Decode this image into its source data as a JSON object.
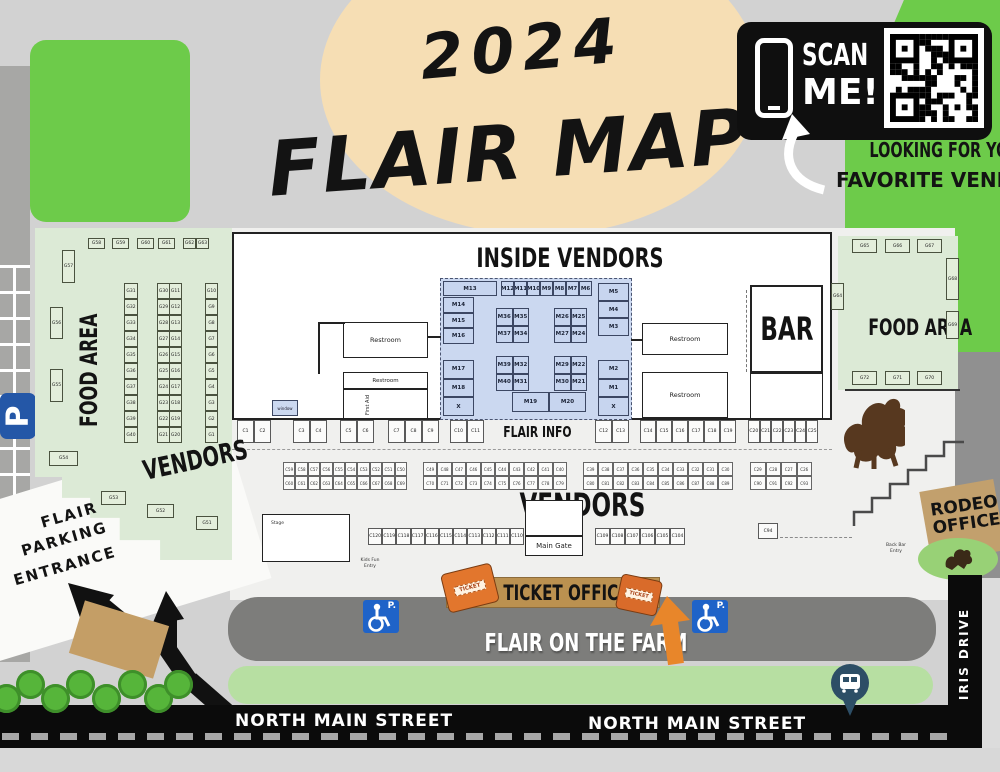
{
  "title": {
    "year": "2024",
    "name": "FLAIR MAP"
  },
  "scan": {
    "line1": "SCAN",
    "line2": "ME!",
    "caption1": "LOOKING FOR YOUR",
    "caption2": "FAVORITE VENDOR?"
  },
  "headings": {
    "inside": "INSIDE VENDORS",
    "vendors_big": "VENDORS",
    "vendors_left": "VENDORS",
    "food_left": "FOOD AREA",
    "food_right": "FOOD AREA",
    "flair_info": "FLAIR INFO",
    "bar": "BAR"
  },
  "roads": {
    "north_main_left": "NORTH MAIN STREET",
    "north_main_right": "NORTH MAIN STREET",
    "iris": "IRIS DRIVE",
    "farm": "FLAIR ON THE FARM"
  },
  "parking": {
    "p": "P",
    "p_dot": "P.",
    "l1": "FLAIR",
    "l2": "PARKING",
    "l3": "ENTRANCE"
  },
  "ticket": {
    "label": "TICKET OFFICE",
    "word": "TICKET"
  },
  "rodeo": {
    "l1": "RODEO",
    "l2": "OFFICE"
  },
  "gate": {
    "label": "Main Gate"
  },
  "fixtures": {
    "restroom": "Restroom",
    "first_aid": "First Aid",
    "window": "window",
    "stage": "Stage",
    "kids1": "Kids Fun",
    "kids2": "Entry",
    "bar1": "Back Bar",
    "bar2": "Entry"
  },
  "left_food": {
    "top_row": [
      "G58",
      "G59",
      "G60",
      "G61"
    ],
    "top_pair": [
      "G62",
      "G63"
    ],
    "singles": {
      "g57": "G57",
      "g56": "G56",
      "g55": "G55",
      "g54": "G54",
      "g53": "G53",
      "g52": "G52",
      "g51": "G51"
    },
    "col1": [
      "G31",
      "G32",
      "G33",
      "G34",
      "G35",
      "G36",
      "G37",
      "G38",
      "G39",
      "G40"
    ],
    "col2a": [
      "G30",
      "G29",
      "G28",
      "G27",
      "G26",
      "G25",
      "G24",
      "G23",
      "G22",
      "G21"
    ],
    "col2b": [
      "G11",
      "G12",
      "G13",
      "G14",
      "G15",
      "G16",
      "G17",
      "G18",
      "G19",
      "G20"
    ],
    "col3": [
      "G10",
      "G9",
      "G8",
      "G7",
      "G6",
      "G5",
      "G4",
      "G3",
      "G2",
      "G1"
    ]
  },
  "right_food": {
    "top_row": [
      "G65",
      "G66",
      "G67"
    ],
    "bottom_row": [
      "G72",
      "G71",
      "G70"
    ],
    "g64": "G64",
    "g68": "G68",
    "g69": "G69"
  },
  "inside": {
    "m13": "M13",
    "top_small": [
      "M12",
      "M11",
      "M10",
      "M9",
      "M8",
      "M7",
      "M6"
    ],
    "left_col": [
      "M14",
      "M15",
      "M16"
    ],
    "right_col": [
      "M5",
      "M4",
      "M3"
    ],
    "island_tl": [
      "M36",
      "M35",
      "M37",
      "M34"
    ],
    "island_tr": [
      "M26",
      "M25",
      "M27",
      "M24"
    ],
    "island_bl": [
      "M39",
      "M32",
      "M40",
      "M31"
    ],
    "island_br": [
      "M29",
      "M22",
      "M30",
      "M21"
    ],
    "left_bottom": [
      "M17",
      "M18",
      "X"
    ],
    "right_bottom": [
      "M2",
      "M1",
      "X"
    ],
    "bottom_center": [
      "M19",
      "M20"
    ]
  },
  "crow1": {
    "b1": [
      "C1",
      "C2"
    ],
    "b2": [
      "C3",
      "C4"
    ],
    "b3": [
      "C5",
      "C6"
    ],
    "b4": [
      "C7",
      "C8",
      "C9"
    ],
    "b5": [
      "C10",
      "C11"
    ],
    "b6": [
      "C12",
      "C13"
    ],
    "b7": [
      "C14",
      "C15",
      "C16",
      "C17",
      "C18",
      "C19"
    ],
    "b8": [
      "C20",
      "C21",
      "C22",
      "C23",
      "C24",
      "C25"
    ]
  },
  "crow2": {
    "a_top": [
      "C59",
      "C58",
      "C57",
      "C56",
      "C55",
      "C54",
      "C53",
      "C52",
      "C51",
      "C50"
    ],
    "a_bot": [
      "C60",
      "C61",
      "C62",
      "C63",
      "C64",
      "C65",
      "C66",
      "C67",
      "C68",
      "C69"
    ],
    "b_top": [
      "C49",
      "C48",
      "C47",
      "C46",
      "C45",
      "C44",
      "C43",
      "C42",
      "C41",
      "C40"
    ],
    "b_bot": [
      "C70",
      "C71",
      "C72",
      "C73",
      "C74",
      "C75",
      "C76",
      "C77",
      "C78",
      "C79"
    ],
    "c_top": [
      "C39",
      "C38",
      "C37",
      "C36",
      "C35",
      "C34",
      "C33",
      "C32",
      "C31",
      "C30"
    ],
    "c_bot": [
      "C80",
      "C81",
      "C82",
      "C83",
      "C84",
      "C85",
      "C86",
      "C87",
      "C88",
      "C89"
    ],
    "d_top": [
      "C29",
      "C28",
      "C27",
      "C26"
    ],
    "d_bot": [
      "C90",
      "C91",
      "C92",
      "C93"
    ]
  },
  "crow3": {
    "left": [
      "C120",
      "C119",
      "C118",
      "C117",
      "C116",
      "C115",
      "C114",
      "C113",
      "C112",
      "C111",
      "C110"
    ],
    "right": [
      "C109",
      "C108",
      "C107",
      "C106",
      "C105",
      "C104"
    ],
    "c94": "C94"
  },
  "colors": {
    "bright_green": "#6dcb4a",
    "pale_green": "#dcead6",
    "grass": "#b7dfa2",
    "blue_booth": "#c7d5ef",
    "tan_circle": "#f6deb4",
    "banner_tan": "#bb9150",
    "orange": "#e2762d",
    "road_dark": "#7d7d7b",
    "street_black": "#0b0b0b",
    "sign_blue": "#2457a7",
    "pin_navy": "#2d4e66",
    "rodeo_brown": "#57381f"
  }
}
